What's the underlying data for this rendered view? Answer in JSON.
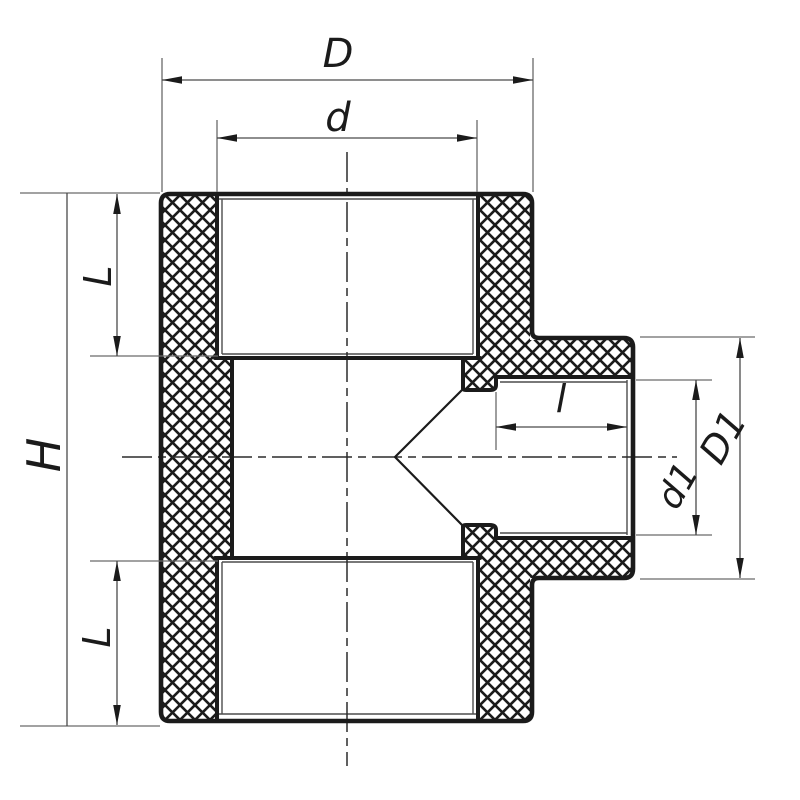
{
  "drawing": {
    "kind": "technical-section-drawing",
    "subject": "pipe-tee-fitting-cross-section",
    "dimension_labels": {
      "overall_width_D": "D",
      "socket_diameter_d": "d",
      "socket_depth_top_L": "L",
      "overall_height_H": "H",
      "socket_depth_bottom_L": "L",
      "branch_socket_depth_l": "l",
      "branch_inner_diameter_d1": "d1",
      "branch_outer_diameter_D1": "D1"
    },
    "colors": {
      "background": "#ffffff",
      "outline": "#1b1b1b",
      "hatch": "#1b1b1b",
      "thin_lines": "#4d4d4d",
      "extension_lines": "#6a6a6a",
      "centerline": "#2b2b2b"
    }
  }
}
